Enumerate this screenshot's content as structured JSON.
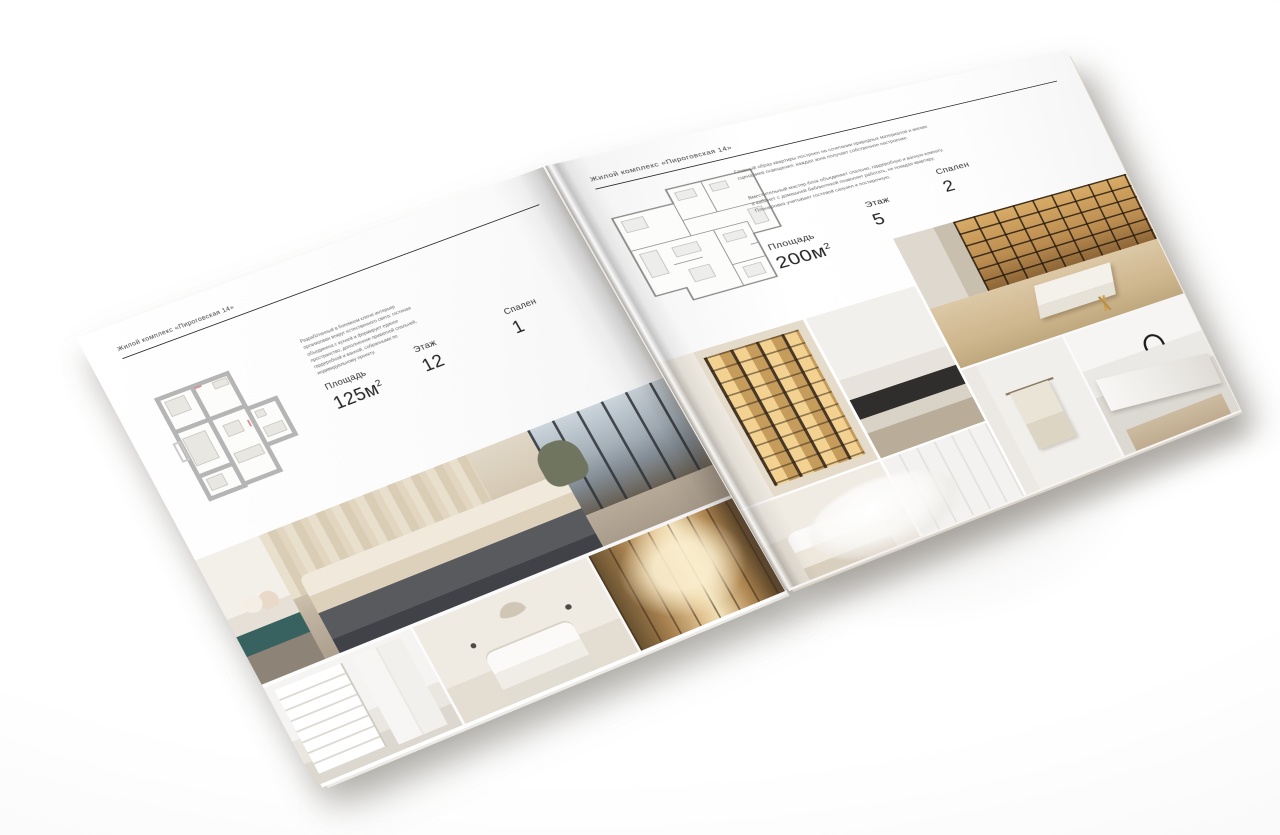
{
  "brochure": {
    "header": "Жилой комплекс «Пироговская 14»",
    "left_page": {
      "description": "Разработанный в богемном ключе интерьер организован вокруг естественного света: гостиная объединена с кухней и формирует единое пространство, дополненное приватной спальней, гардеробной и ванной, собранными по индивидуальному проекту.",
      "stats": [
        {
          "label": "Площадь",
          "value": "125м",
          "sup": "2"
        },
        {
          "label": "Этаж",
          "value": "12"
        },
        {
          "label": "Спален",
          "value": "1"
        }
      ]
    },
    "right_page": {
      "description_1": "Главный образ квартиры построен на сочетании природных материалов и мягких сценариев освещения: каждая зона получает собственное настроение.",
      "description_2": "Вместительный мастер-блок объединяет спальню, гардеробную и ванную комнату, а кабинет с домашней библиотекой позволяет работать, не покидая квартиру. Планировка учитывает гостевой санузел и постирочную.",
      "stats": [
        {
          "label": "Площадь",
          "value": "200м",
          "sup": "2"
        },
        {
          "label": "Этаж",
          "value": "5"
        },
        {
          "label": "Спален",
          "value": "2"
        }
      ]
    },
    "photos": {
      "left": [
        "master-bedroom-panorama",
        "white-bedroom-shelving",
        "canopy-bedroom",
        "library-corridor"
      ],
      "right": [
        "home-office-library",
        "lighted-wardrobe",
        "hall-with-desk",
        "bathroom-towel",
        "marble-washbasin",
        "white-bedroom",
        "panelled-bathroom"
      ]
    },
    "colors": {
      "paper": "#ffffff",
      "ink": "#2e2e2e",
      "plan_walls": "#b5b5b5",
      "warm_wood": "#c59c5c",
      "shadow": "#8a847c"
    }
  }
}
